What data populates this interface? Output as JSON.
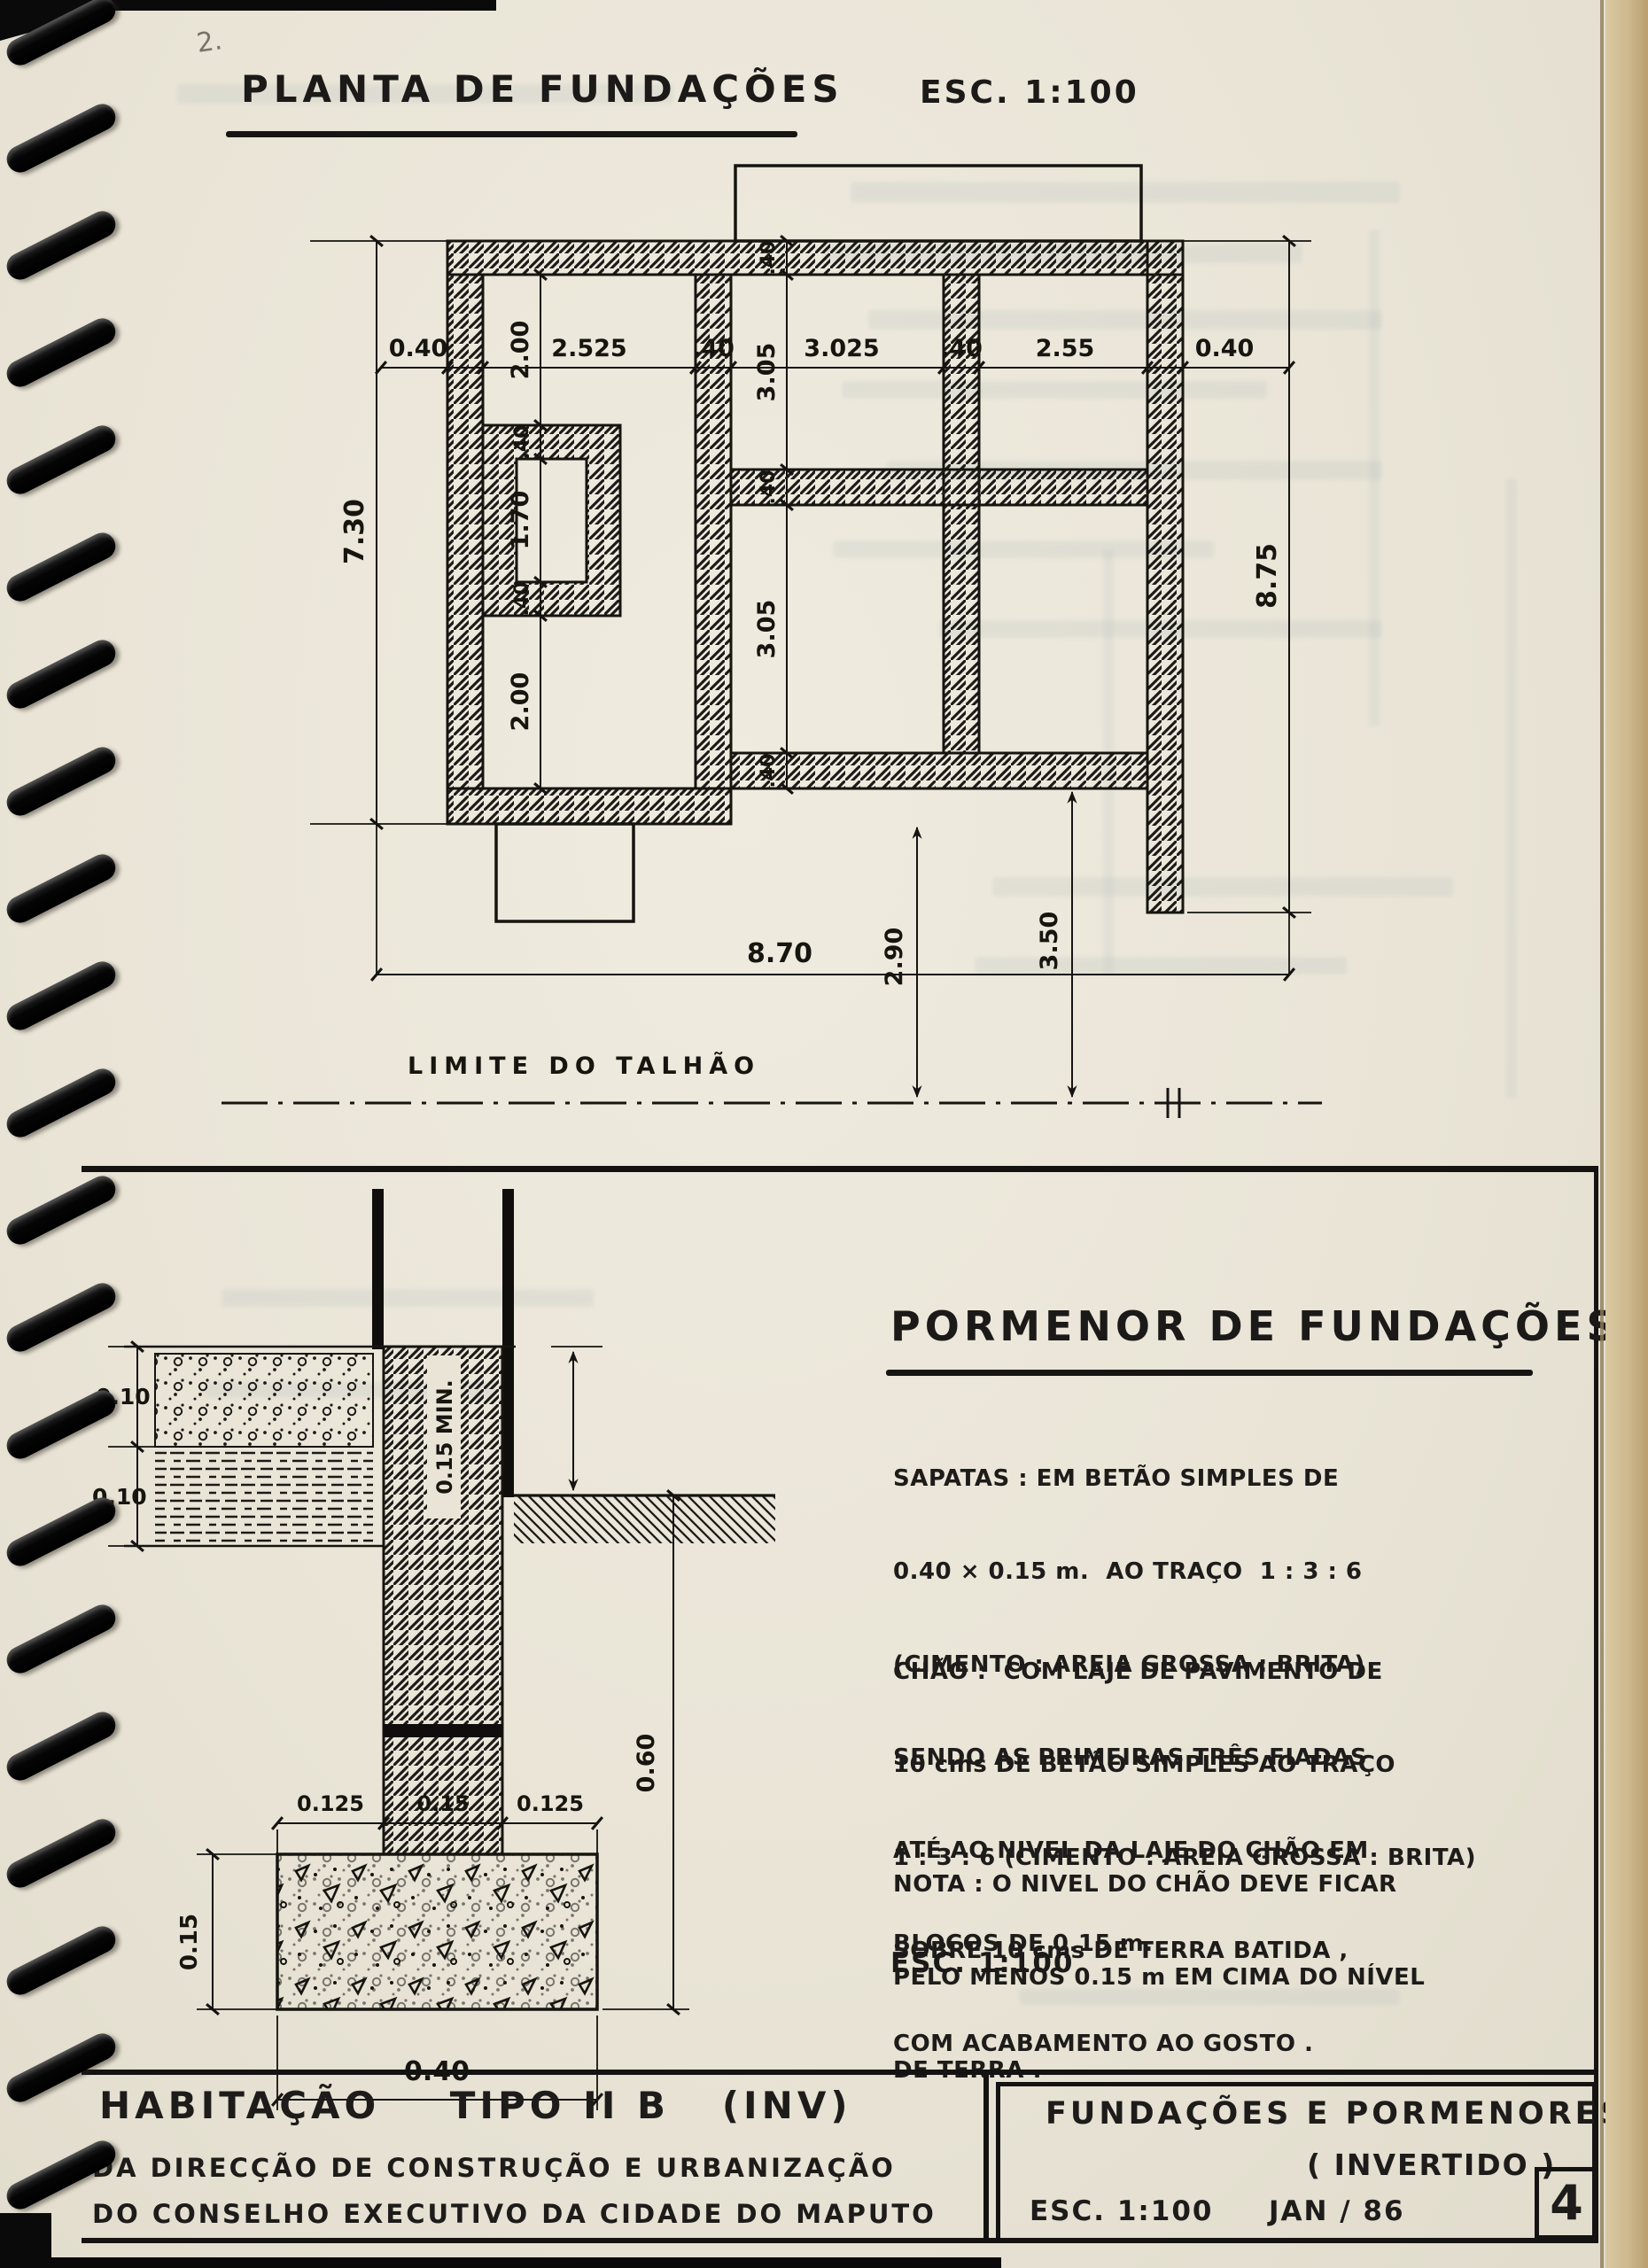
{
  "page": {
    "title": "PLANTA DE FUNDAÇÕES",
    "title_scale": "ESC. 1:100",
    "corner_note": "2.",
    "boundary_label": "LIMITE DO TALHÃO"
  },
  "plan_dims": {
    "top_row": [
      "0.40",
      "2.525",
      ".40",
      "3.025",
      ".40",
      "2.55",
      "0.40"
    ],
    "col_a": [
      "2.00",
      ".40",
      "1.70",
      ".40",
      "2.00"
    ],
    "col_b": [
      ".40",
      "3.05",
      ".40",
      "3.05",
      ".40"
    ],
    "left_total": "7.30",
    "right_total": "8.75",
    "bottom_total": "8.70",
    "to_boundary_left": "2.90",
    "to_boundary_right": "3.50"
  },
  "section_dims": {
    "slab": "0.10",
    "fill": "0.10",
    "min_height": "0.15 MIN.",
    "depth": "0.60",
    "w_left": "0.125",
    "w_mid": "0.15",
    "w_right": "0.125",
    "footing_h": "0.15",
    "footing_w": "0.40"
  },
  "pormenor": {
    "title": "PORMENOR DE FUNDAÇÕES",
    "sapatas_lines": [
      "SAPATAS : EM BETÃO SIMPLES DE",
      "0.40 × 0.15 m.  AO TRAÇO  1 : 3 : 6",
      "(CIMENTO : AREIA GROSSA : BRITA)",
      "SENDO AS PRIMEIRAS TRÊS FIADAS",
      "ATÉ AO NIVEL DA LAJE DO CHÃO EM",
      "BLOCOS DE 0.15 m."
    ],
    "chao_lines": [
      "CHÃO :  COM LAJE DE PAVIMENTO DE",
      "10 cms DE BETÃO SIMPLES AO TRAÇO",
      "1 : 3 : 6 (CIMENTO : AREIA GROSSA : BRITA)",
      "SOBRE 10 cms DE TERRA BATIDA ,",
      "COM ACABAMENTO AO GOSTO ."
    ],
    "nota_lines": [
      "NOTA : O NIVEL DO CHÃO DEVE FICAR",
      "PELO MENOS 0.15 m EM CIMA DO NÍVEL",
      "DE TERRA ."
    ],
    "scale": "ESC. 1:100"
  },
  "titleblock": {
    "project": "HABITAÇÃO    TIPO II B   (INV)",
    "org1": "DA DIRECÇÃO DE CONSTRUÇÃO E URBANIZAÇÃO",
    "org2": "DO CONSELHO EXECUTIVO DA CIDADE DO MAPUTO",
    "sheet_title": "FUNDAÇÕES E PORMENORES",
    "sheet_sub": "( INVERTIDO )",
    "scale": "ESC. 1:100",
    "date": "JAN / 86",
    "sheet_no": "4"
  }
}
